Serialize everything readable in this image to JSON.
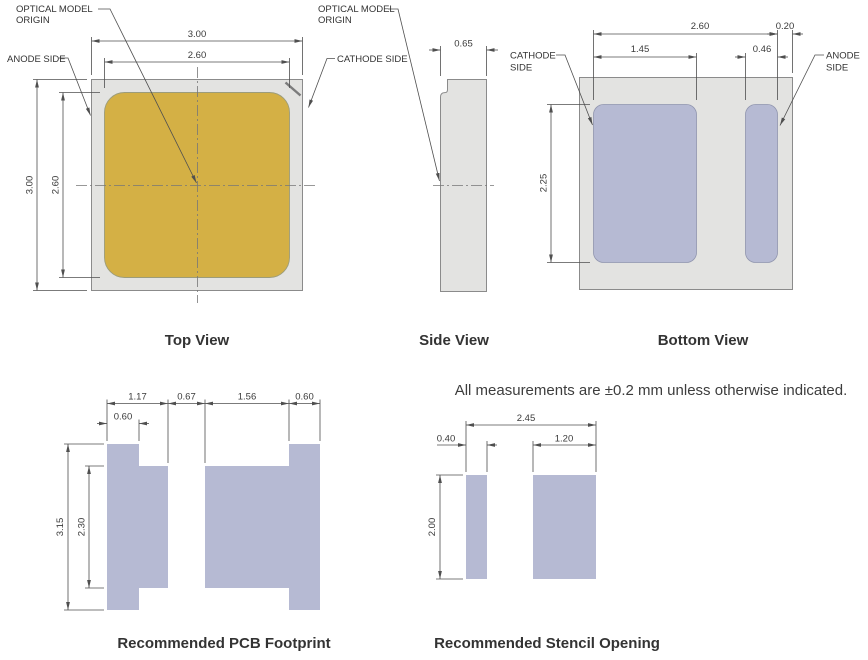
{
  "note": "All measurements are ±0.2 mm unless otherwise indicated.",
  "colors": {
    "package_fill": "#e3e3e1",
    "package_stroke": "#8b8b8b",
    "emitter_fill": "#d4b045",
    "pad_fill": "#b6bad3",
    "line": "#4f4f4f",
    "text": "#3a3a3a"
  },
  "top_view": {
    "title": "Top View",
    "label_optical_origin_l1": "OPTICAL MODEL",
    "label_optical_origin_l2": "ORIGIN",
    "label_anode": "ANODE SIDE",
    "label_cathode": "CATHODE SIDE",
    "dim_outer_width": "3.00",
    "dim_emitter_width": "2.60",
    "dim_outer_height": "3.00",
    "dim_emitter_height": "2.60"
  },
  "side_view": {
    "title": "Side View",
    "label_optical_origin_l1": "OPTICAL MODEL",
    "label_optical_origin_l2": "ORIGIN",
    "dim_thickness": "0.65"
  },
  "bottom_view": {
    "title": "Bottom View",
    "label_cathode_l1": "CATHODE",
    "label_cathode_l2": "SIDE",
    "label_anode_l1": "ANODE",
    "label_anode_l2": "SIDE",
    "dim_pads_span": "2.60",
    "dim_edge_gap": "0.20",
    "dim_cathode_pad_width": "1.45",
    "dim_anode_pad_width": "0.46",
    "dim_pad_height": "2.25"
  },
  "pcb_footprint": {
    "title": "Recommended PCB Footprint",
    "dim_cathode_pad_width": "1.17",
    "dim_pad_gap": "0.67",
    "dim_anode_pad_width": "1.56",
    "dim_anode_tab_width": "0.60",
    "dim_cathode_tab_width": "0.60",
    "dim_overall_height": "3.15",
    "dim_pad_body_height": "2.30"
  },
  "stencil": {
    "title": "Recommended Stencil Opening",
    "dim_overall_width": "2.45",
    "dim_cathode_opening_width": "0.40",
    "dim_anode_opening_width": "1.20",
    "dim_opening_height": "2.00"
  }
}
